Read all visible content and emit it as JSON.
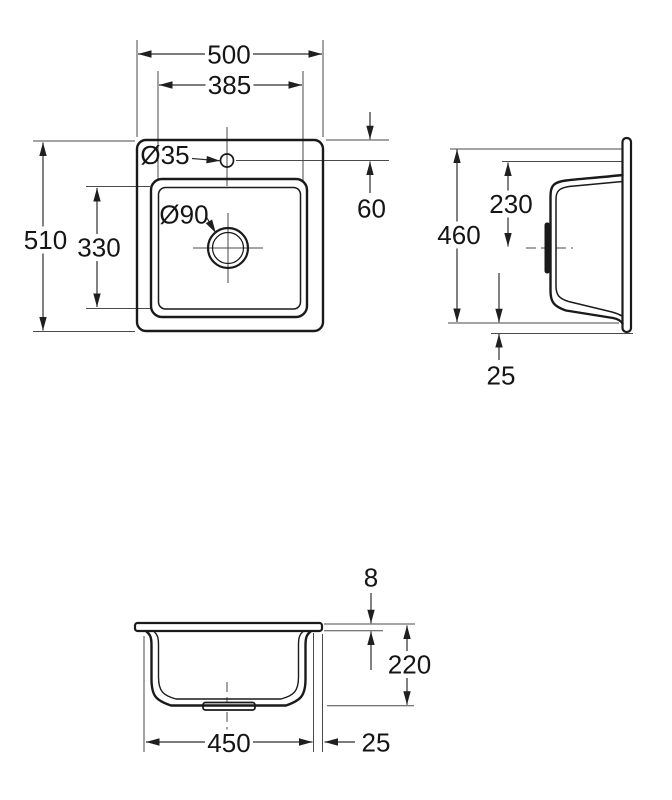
{
  "dims": {
    "top_overall_width": "500",
    "top_cutout_width": "385",
    "top_overall_depth": "510",
    "top_bowl_depth": "330",
    "top_taphole_offset": "60",
    "top_taphole_diameter": "Ø35",
    "top_drain_diameter": "Ø90",
    "side_overall_height": "460",
    "side_drain_center_height": "230",
    "side_bottom_offset": "25",
    "front_rim_thickness": "8",
    "front_bowl_depth": "220",
    "front_bowl_width": "450",
    "front_edge_offset": "25"
  },
  "colors": {
    "outline": "#1a1a1a",
    "dimension_line": "#2d2d2d",
    "extension_line": "#4a4a4a",
    "text": "#151515",
    "background": "#ffffff"
  }
}
